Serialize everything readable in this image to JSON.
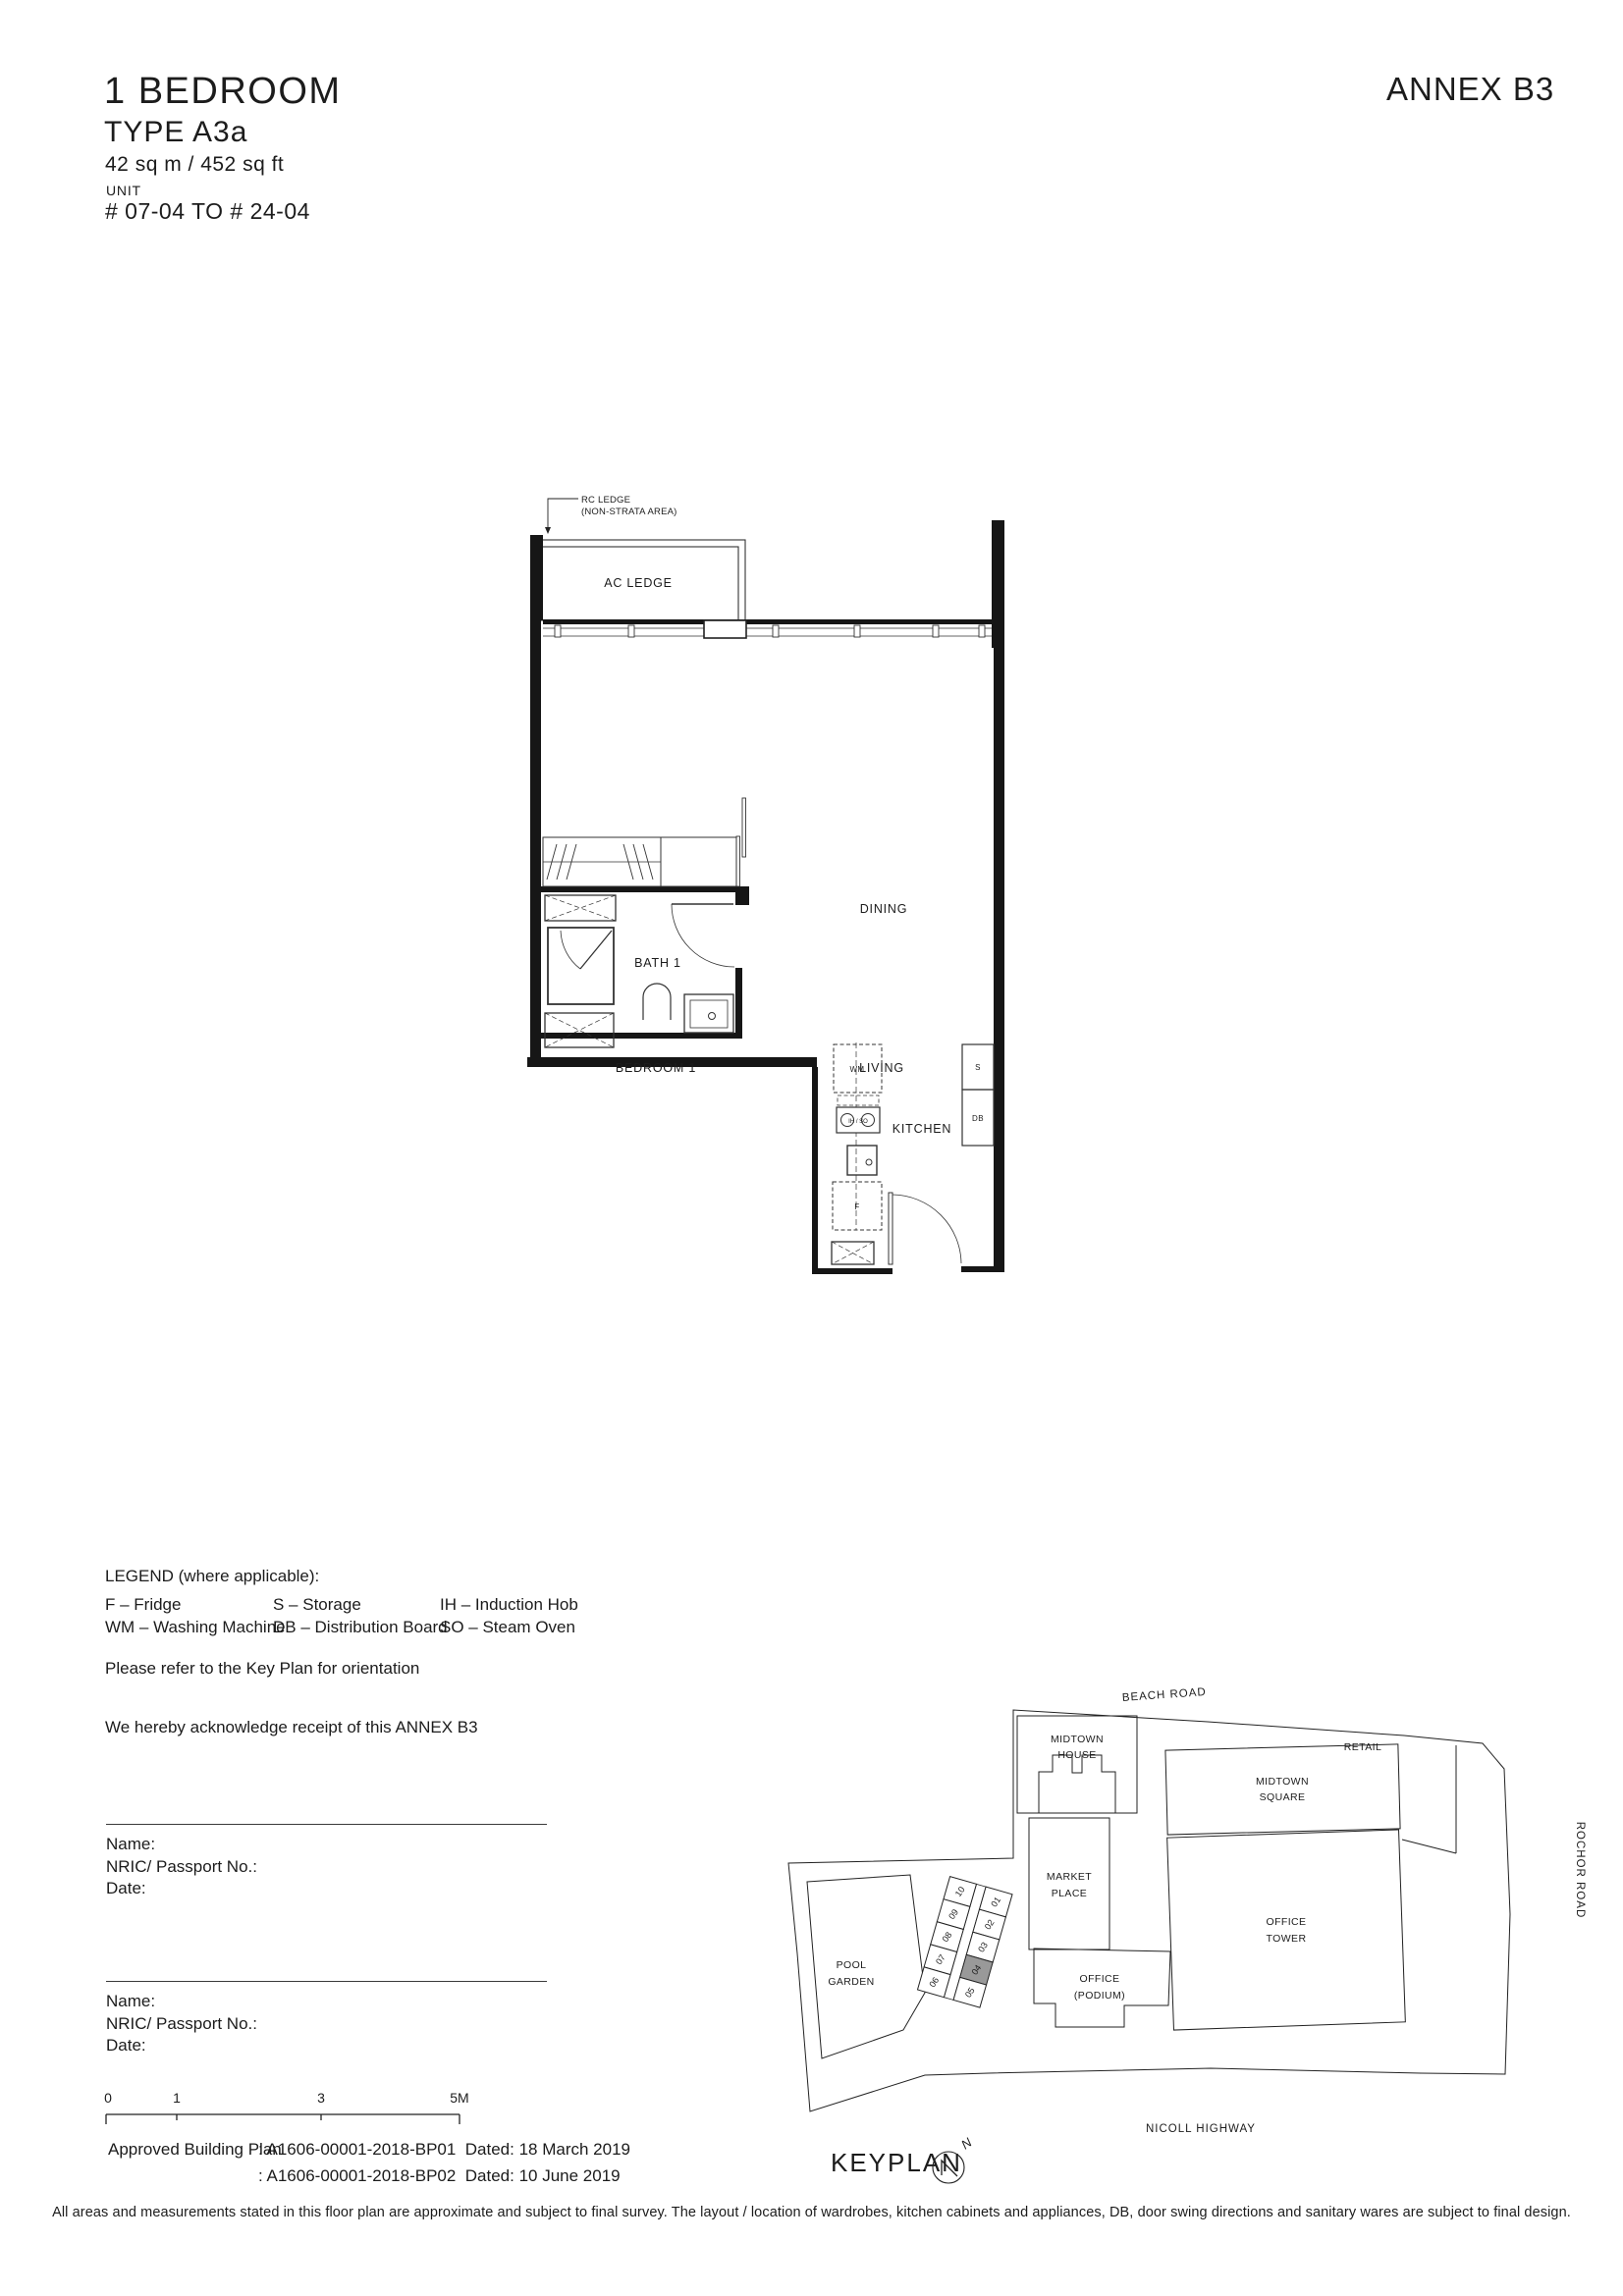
{
  "header": {
    "title": "1 BEDROOM",
    "type": "TYPE A3a",
    "area": "42 sq m / 452 sq ft",
    "unit_label": "UNIT",
    "unit_range": "# 07-04 TO # 24-04",
    "annex": "ANNEX B3"
  },
  "floorplan": {
    "rc_ledge_line1": "RC LEDGE",
    "rc_ledge_line2": "(NON-STRATA AREA)",
    "ac_ledge": "AC LEDGE",
    "bedroom": "BEDROOM 1",
    "living": "LIVING",
    "dining": "DINING",
    "bath": "BATH 1",
    "kitchen": "KITCHEN",
    "wm": "WM",
    "ih_so": "IH / SO",
    "fridge": "F",
    "storage": "S",
    "db": "DB"
  },
  "legend": {
    "heading": "LEGEND (where applicable):",
    "col1": [
      "F – Fridge",
      "WM – Washing Machine"
    ],
    "col2": [
      "S – Storage",
      "DB – Distribution Board"
    ],
    "col3": [
      "IH – Induction Hob",
      "SO – Steam Oven"
    ]
  },
  "notes": {
    "orientation": "Please refer to the Key Plan for orientation",
    "receipt": "We hereby acknowledge receipt of this ANNEX B3"
  },
  "signatures": [
    {
      "name": "Name:",
      "nric": "NRIC/ Passport No.:",
      "date": "Date:"
    },
    {
      "name": "Name:",
      "nric": "NRIC/ Passport No.:",
      "date": "Date:"
    }
  ],
  "scalebar": {
    "t0": "0",
    "t1": "1",
    "t3": "3",
    "t5": "5M"
  },
  "approval": {
    "label": "Approved Building Plan",
    "line1": ": A1606-00001-2018-BP01  Dated: 18 March 2019",
    "line2": ": A1606-00001-2018-BP02  Dated: 10 June 2019"
  },
  "keyplan": {
    "label": "KEYPLAN",
    "north": "N",
    "beach_road": "BEACH ROAD",
    "rochor_road": "ROCHOR ROAD",
    "nicoll_highway": "NICOLL HIGHWAY",
    "retail": "RETAIL",
    "midtown_house_1": "MIDTOWN",
    "midtown_house_2": "HOUSE",
    "midtown_square_1": "MIDTOWN",
    "midtown_square_2": "SQUARE",
    "market_place_1": "MARKET",
    "market_place_2": "PLACE",
    "office_tower_1": "OFFICE",
    "office_tower_2": "TOWER",
    "office_podium_1": "OFFICE",
    "office_podium_2": "(PODIUM)",
    "pool_garden_1": "POOL",
    "pool_garden_2": "GARDEN",
    "units_left": [
      "10",
      "09",
      "08",
      "07",
      "06"
    ],
    "units_right": [
      "01",
      "02",
      "03",
      "04",
      "05"
    ],
    "highlighted_unit": "04",
    "highlight_color": "#999999"
  },
  "disclaimer": "All areas and measurements stated in this floor plan are approximate and subject to final survey. The layout / location of wardrobes, kitchen cabinets and appliances, DB, door swing directions and sanitary wares are subject to final design."
}
